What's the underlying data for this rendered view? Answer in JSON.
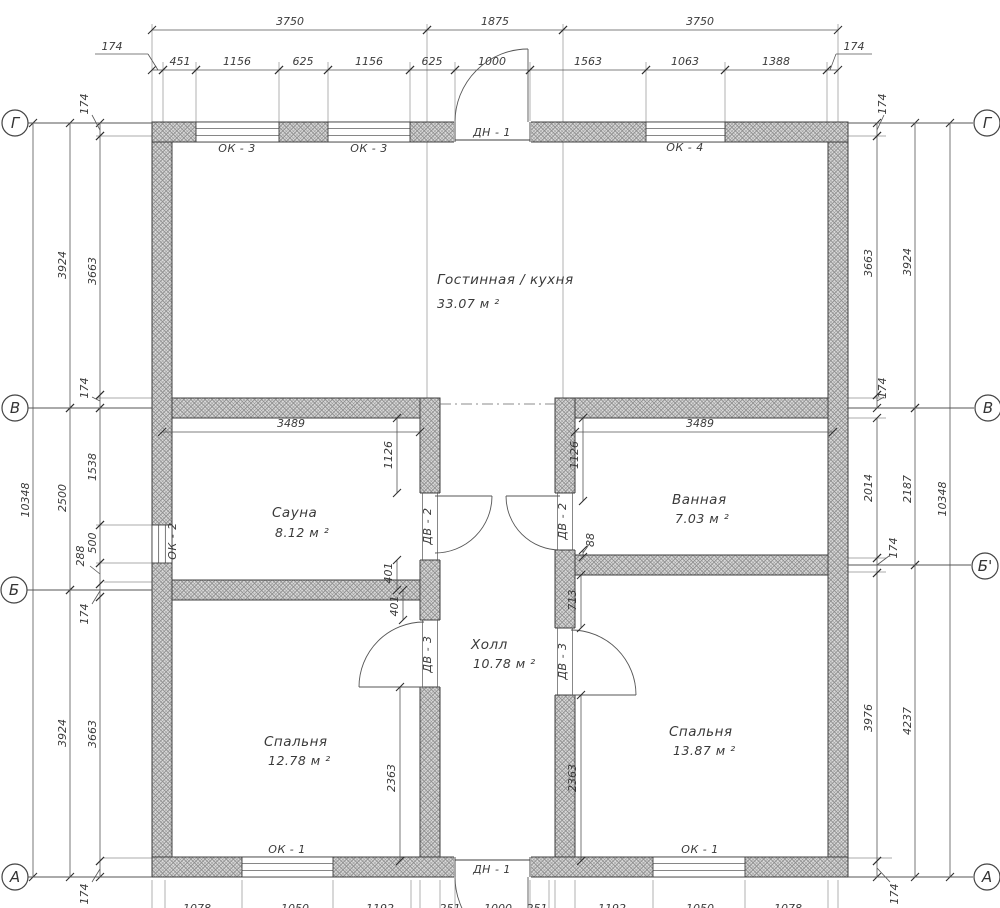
{
  "drawing_title": "Floor plan",
  "axes": {
    "left": [
      "Г",
      "В",
      "Б",
      "А"
    ],
    "right": [
      "Г",
      "В",
      "Б'",
      "А"
    ]
  },
  "rooms": [
    {
      "name": "Гостинная / кухня",
      "area": "33.07 м ²"
    },
    {
      "name": "Сауна",
      "area": "8.12 м ²"
    },
    {
      "name": "Ванная",
      "area": "7.03 м ²"
    },
    {
      "name": "Холл",
      "area": "10.78 м ²"
    },
    {
      "name": "Спальня",
      "area": "12.78 м ²"
    },
    {
      "name": "Спальня",
      "area": "13.87 м ²"
    }
  ],
  "window_labels": {
    "ok1": "ОК - 1",
    "ok2": "ОК - 2",
    "ok3": "ОК - 3",
    "ok4": "ОК - 4"
  },
  "door_labels": {
    "dn1": "ДН - 1",
    "dv2": "ДВ - 2",
    "dv3": "ДВ - 3"
  },
  "dims": [
    {
      "o": "h",
      "p": 30,
      "a": 152,
      "b": 427,
      "t": "3750",
      "lx": 290,
      "ly": 25
    },
    {
      "o": "h",
      "p": 30,
      "a": 427,
      "b": 563,
      "t": "1875",
      "lx": 495,
      "ly": 25
    },
    {
      "o": "h",
      "p": 30,
      "a": 563,
      "b": 838,
      "t": "3750",
      "lx": 700,
      "ly": 25
    },
    {
      "o": "h",
      "p": 70,
      "a": 152,
      "b": 163,
      "t": "174",
      "lx": 112,
      "ly": 50,
      "ul": [
        95,
        54,
        148,
        54
      ],
      "ldr": [
        148,
        54,
        158,
        70
      ]
    },
    {
      "o": "h",
      "p": 70,
      "a": 163,
      "b": 196,
      "t": "451",
      "lx": 180,
      "ly": 65
    },
    {
      "o": "h",
      "p": 70,
      "a": 196,
      "b": 279,
      "t": "1156",
      "lx": 237,
      "ly": 65
    },
    {
      "o": "h",
      "p": 70,
      "a": 279,
      "b": 328,
      "t": "625",
      "lx": 303,
      "ly": 65
    },
    {
      "o": "h",
      "p": 70,
      "a": 328,
      "b": 410,
      "t": "1156",
      "lx": 369,
      "ly": 65
    },
    {
      "o": "h",
      "p": 70,
      "a": 410,
      "b": 455,
      "t": "625",
      "lx": 432,
      "ly": 65
    },
    {
      "o": "h",
      "p": 70,
      "a": 455,
      "b": 530,
      "t": "1000",
      "lx": 492,
      "ly": 65
    },
    {
      "o": "h",
      "p": 70,
      "a": 530,
      "b": 646,
      "t": "1563",
      "lx": 588,
      "ly": 65
    },
    {
      "o": "h",
      "p": 70,
      "a": 646,
      "b": 725,
      "t": "1063",
      "lx": 685,
      "ly": 65
    },
    {
      "o": "h",
      "p": 70,
      "a": 725,
      "b": 827,
      "t": "1388",
      "lx": 776,
      "ly": 65
    },
    {
      "o": "h",
      "p": 70,
      "a": 827,
      "b": 838,
      "t": "174",
      "lx": 854,
      "ly": 50,
      "ul": [
        836,
        54,
        872,
        54
      ],
      "ldr": [
        836,
        54,
        830,
        70
      ]
    },
    {
      "o": "h",
      "p": 432,
      "a": 162,
      "b": 420,
      "t": "3489",
      "lx": 291,
      "ly": 427
    },
    {
      "o": "h",
      "p": 432,
      "a": 575,
      "b": 833,
      "t": "3489",
      "lx": 700,
      "ly": 427
    },
    {
      "o": "v",
      "p": 33,
      "a": 123,
      "b": 877,
      "t": "10348",
      "lx": 29,
      "ly": 500
    },
    {
      "o": "v",
      "p": 70,
      "a": 123,
      "b": 408,
      "t": "3924",
      "lx": 66,
      "ly": 265
    },
    {
      "o": "v",
      "p": 70,
      "a": 408,
      "b": 590,
      "t": "2500",
      "lx": 66,
      "ly": 498
    },
    {
      "o": "v",
      "p": 70,
      "a": 590,
      "b": 877,
      "t": "3924",
      "lx": 66,
      "ly": 733
    },
    {
      "o": "v",
      "p": 100,
      "a": 123,
      "b": 136,
      "t": "174",
      "lx": 88,
      "ly": 104,
      "ldr": [
        100,
        130,
        92,
        115
      ]
    },
    {
      "o": "v",
      "p": 100,
      "a": 136,
      "b": 395,
      "t": "3663",
      "lx": 96,
      "ly": 271
    },
    {
      "o": "v",
      "p": 100,
      "a": 395,
      "b": 408,
      "t": "174",
      "lx": 88,
      "ly": 388,
      "ldr": [
        100,
        401,
        92,
        397
      ]
    },
    {
      "o": "v",
      "p": 100,
      "a": 408,
      "b": 525,
      "t": "1538",
      "lx": 96,
      "ly": 467
    },
    {
      "o": "v",
      "p": 100,
      "a": 525,
      "b": 563,
      "t": "500",
      "lx": 96,
      "ly": 543
    },
    {
      "o": "v",
      "p": 100,
      "a": 563,
      "b": 584,
      "t": "288",
      "lx": 84,
      "ly": 556,
      "ldr": [
        100,
        574,
        90,
        566
      ]
    },
    {
      "o": "v",
      "p": 100,
      "a": 584,
      "b": 597,
      "t": "174",
      "lx": 88,
      "ly": 614,
      "ldr": [
        100,
        591,
        92,
        604
      ]
    },
    {
      "o": "v",
      "p": 100,
      "a": 597,
      "b": 861,
      "t": "3663",
      "lx": 96,
      "ly": 734
    },
    {
      "o": "v",
      "p": 100,
      "a": 861,
      "b": 877,
      "t": "174",
      "lx": 88,
      "ly": 894,
      "ldr": [
        100,
        869,
        92,
        882
      ]
    },
    {
      "o": "v",
      "p": 877,
      "a": 123,
      "b": 136,
      "t": "174",
      "lx": 886,
      "ly": 104,
      "ldr": [
        877,
        130,
        884,
        115
      ]
    },
    {
      "o": "v",
      "p": 877,
      "a": 136,
      "b": 395,
      "t": "3663",
      "lx": 872,
      "ly": 263
    },
    {
      "o": "v",
      "p": 877,
      "a": 395,
      "b": 408,
      "t": "174",
      "lx": 886,
      "ly": 388,
      "ldr": [
        877,
        401,
        884,
        397
      ]
    },
    {
      "o": "v",
      "p": 877,
      "a": 418,
      "b": 558,
      "t": "2014",
      "lx": 872,
      "ly": 488
    },
    {
      "o": "v",
      "p": 877,
      "a": 558,
      "b": 573,
      "t": "174",
      "lx": 897,
      "ly": 548,
      "ldr": [
        877,
        565,
        889,
        556
      ]
    },
    {
      "o": "v",
      "p": 877,
      "a": 573,
      "b": 861,
      "t": "3976",
      "lx": 872,
      "ly": 718
    },
    {
      "o": "v",
      "p": 877,
      "a": 861,
      "b": 877,
      "t": "174",
      "lx": 898,
      "ly": 894,
      "ldr": [
        877,
        868,
        890,
        882
      ]
    },
    {
      "o": "v",
      "p": 915,
      "a": 123,
      "b": 408,
      "t": "3924",
      "lx": 911,
      "ly": 262
    },
    {
      "o": "v",
      "p": 915,
      "a": 408,
      "b": 565,
      "t": "2187",
      "lx": 911,
      "ly": 489
    },
    {
      "o": "v",
      "p": 915,
      "a": 565,
      "b": 877,
      "t": "4237",
      "lx": 911,
      "ly": 721
    },
    {
      "o": "v",
      "p": 950,
      "a": 123,
      "b": 877,
      "t": "10348",
      "lx": 946,
      "ly": 499
    },
    {
      "o": "v",
      "p": 397,
      "a": 418,
      "b": 493,
      "t": "1126",
      "lx": 392,
      "ly": 455
    },
    {
      "o": "v",
      "p": 397,
      "a": 560,
      "b": 590,
      "t": "401",
      "lx": 392,
      "ly": 573
    },
    {
      "o": "v",
      "p": 403,
      "a": 590,
      "b": 620,
      "t": "401",
      "lx": 398,
      "ly": 606
    },
    {
      "o": "v",
      "p": 400,
      "a": 687,
      "b": 861,
      "t": "2363",
      "lx": 395,
      "ly": 778
    },
    {
      "o": "v",
      "p": 583,
      "a": 418,
      "b": 501,
      "t": "1126",
      "lx": 578,
      "ly": 455
    },
    {
      "o": "v",
      "p": 583,
      "a": 550,
      "b": 557,
      "t": "88",
      "lx": 594,
      "ly": 540,
      "ldr": [
        583,
        553,
        588,
        546
      ]
    },
    {
      "o": "v",
      "p": 581,
      "a": 575,
      "b": 628,
      "t": "713",
      "lx": 576,
      "ly": 600
    },
    {
      "o": "v",
      "p": 581,
      "a": 695,
      "b": 861,
      "t": "2363",
      "lx": 576,
      "ly": 778
    },
    {
      "o": "t",
      "t": "1078",
      "lx": 197,
      "ly": 912,
      "fs": 12.5
    },
    {
      "o": "t",
      "t": "1050",
      "lx": 295,
      "ly": 912,
      "fs": 12.5
    },
    {
      "o": "t",
      "t": "1192",
      "lx": 380,
      "ly": 912,
      "fs": 12.5
    },
    {
      "o": "t",
      "t": "251",
      "lx": 450,
      "ly": 912,
      "fs": 12.5
    },
    {
      "o": "t",
      "t": "1000",
      "lx": 498,
      "ly": 912,
      "fs": 12.5
    },
    {
      "o": "t",
      "t": "251",
      "lx": 537,
      "ly": 912,
      "fs": 12.5
    },
    {
      "o": "t",
      "t": "1192",
      "lx": 612,
      "ly": 912,
      "fs": 12.5
    },
    {
      "o": "t",
      "t": "1050",
      "lx": 700,
      "ly": 912,
      "fs": 12.5
    },
    {
      "o": "t",
      "t": "1078",
      "lx": 788,
      "ly": 912,
      "fs": 12.5
    }
  ]
}
